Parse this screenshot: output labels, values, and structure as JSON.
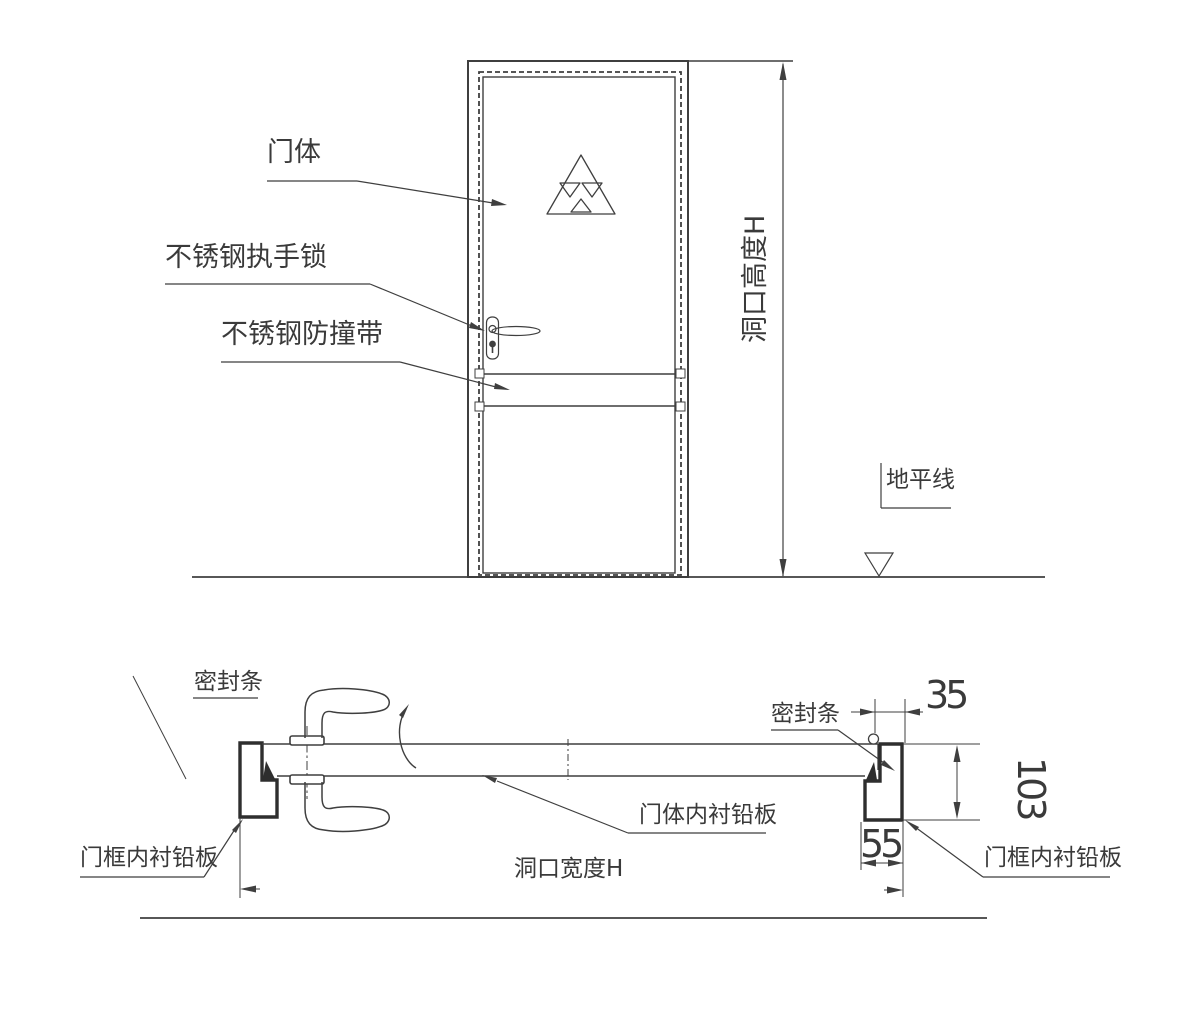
{
  "elevation": {
    "door_body_label": "门体",
    "handle_lock_label": "不锈钢执手锁",
    "bumper_strip_label": "不锈钢防撞带",
    "opening_height_label": "洞口高度H",
    "ground_line_label": "地平线"
  },
  "section": {
    "seal_left_label": "密封条",
    "seal_right_label": "密封条",
    "door_lead_lining_label": "门体内衬铅板",
    "frame_lead_lining_left_label": "门框内衬铅板",
    "frame_lead_lining_right_label": "门框内衬铅板",
    "opening_width_label": "洞口宽度H",
    "dim_frame_face": "35",
    "dim_frame_depth": "103",
    "dim_frame_rebate": "55"
  },
  "colors": {
    "line": "#3f3f3f",
    "thick_line": "#2e2e2e",
    "background": "#ffffff"
  }
}
